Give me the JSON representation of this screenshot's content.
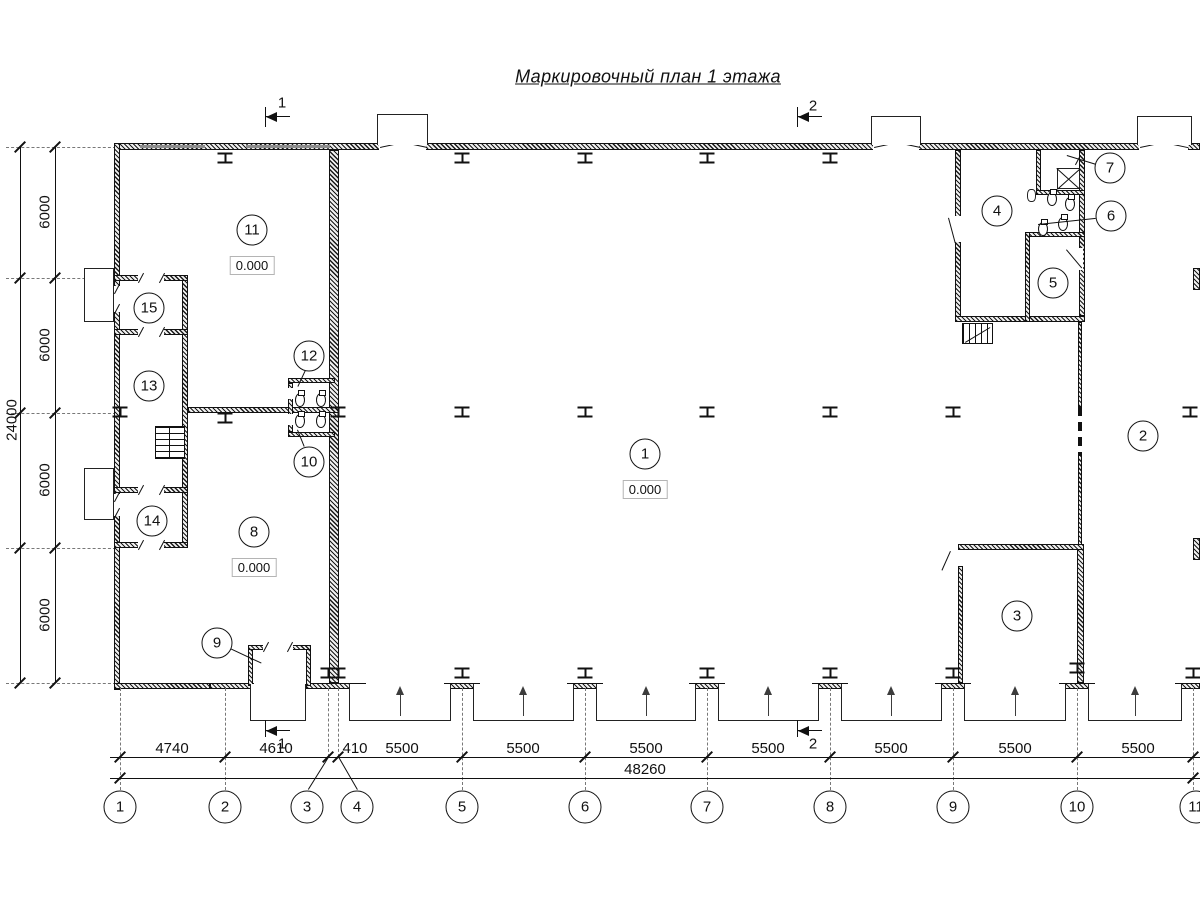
{
  "title": "Маркировочный план 1 этажа",
  "sections": {
    "s1": "1",
    "s2": "2"
  },
  "rooms": [
    {
      "num": "1",
      "elev": "0.000"
    },
    {
      "num": "2"
    },
    {
      "num": "3"
    },
    {
      "num": "4"
    },
    {
      "num": "5"
    },
    {
      "num": "6"
    },
    {
      "num": "7"
    },
    {
      "num": "8",
      "elev": "0.000"
    },
    {
      "num": "9"
    },
    {
      "num": "10"
    },
    {
      "num": "11",
      "elev": "0.000"
    },
    {
      "num": "12"
    },
    {
      "num": "13"
    },
    {
      "num": "14"
    },
    {
      "num": "15"
    }
  ],
  "grid_axes": [
    "1",
    "2",
    "3",
    "4",
    "5",
    "6",
    "7",
    "8",
    "9",
    "10",
    "11"
  ],
  "dims": {
    "bottom": [
      "4740",
      "4610",
      "410",
      "5500",
      "5500",
      "5500",
      "5500",
      "5500",
      "5500",
      "5500"
    ],
    "bottom_total": "48260",
    "left": [
      "6000",
      "6000",
      "6000",
      "6000"
    ],
    "left_total": "24000"
  }
}
